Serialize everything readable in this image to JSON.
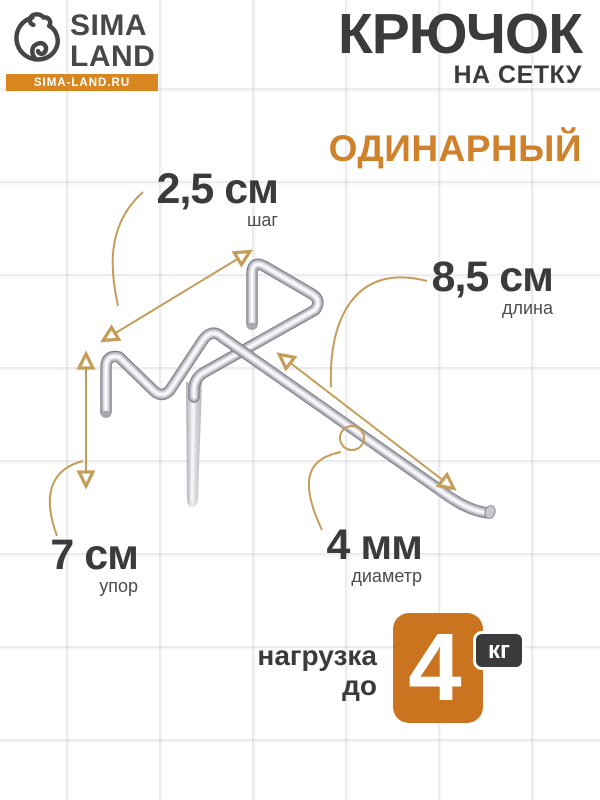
{
  "brand": {
    "line1": "SIMA",
    "line2": "LAND",
    "site": "SIMA-LAND.RU"
  },
  "title": {
    "main": "КРЮЧОК",
    "sub": "НА СЕТКУ"
  },
  "variant": "ОДИНАРНЫЙ",
  "dimensions": {
    "step": {
      "value": "2,5 см",
      "label": "шаг"
    },
    "length": {
      "value": "8,5 см",
      "label": "длина"
    },
    "stop": {
      "value": "7 см",
      "label": "упор"
    },
    "diameter": {
      "value": "4 мм",
      "label": "диаметр"
    }
  },
  "load": {
    "line1": "нагрузка",
    "line2": "до",
    "value": "4",
    "unit": "кг"
  },
  "colors": {
    "accent_orange": "#ca7420",
    "logo_bar_orange": "#d8861f",
    "variant_orange": "#d0812b",
    "text_dark": "#3b3b3d",
    "annotation_tan": "#c49d58",
    "grid_line": "#e9e9ed"
  },
  "icons": {
    "logo": "bear-icon"
  }
}
